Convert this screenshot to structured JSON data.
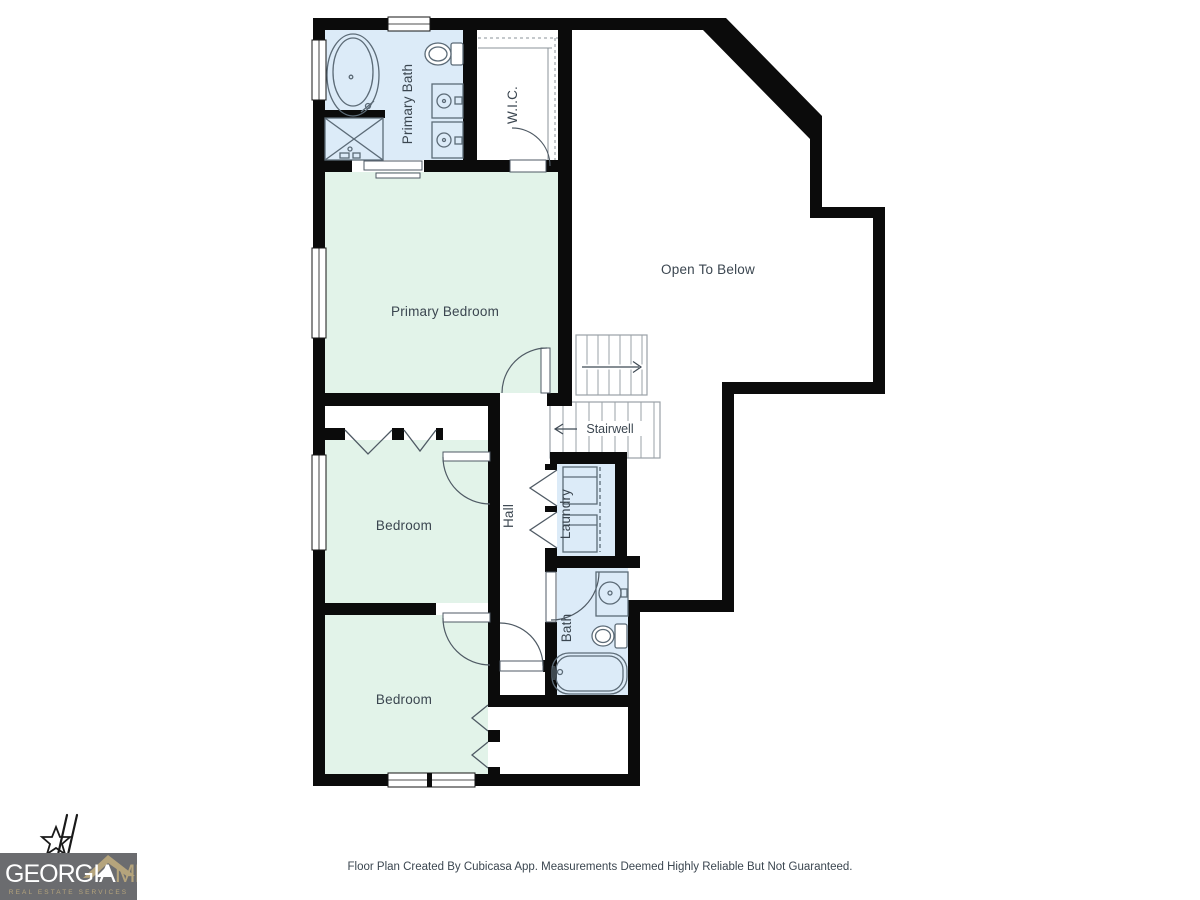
{
  "plan": {
    "rooms": {
      "primary_bath": {
        "label": "Primary Bath"
      },
      "wic": {
        "label": "W.I.C."
      },
      "open_to_below": {
        "label": "Open To Below"
      },
      "primary_bedroom": {
        "label": "Primary Bedroom"
      },
      "stairwell": {
        "label": "Stairwell"
      },
      "hall": {
        "label": "Hall"
      },
      "laundry": {
        "label": "Laundry"
      },
      "bedroom_upper": {
        "label": "Bedroom"
      },
      "bedroom_lower": {
        "label": "Bedroom"
      },
      "bath": {
        "label": "Bath"
      }
    }
  },
  "footer": {
    "disclaimer": "Floor Plan Created By Cubicasa App. Measurements Deemed Highly Reliable But Not Guaranteed."
  },
  "logo": {
    "brand_primary": "GEORGIA",
    "brand_secondary": "MLS",
    "tagline": "REAL ESTATE SERVICES"
  },
  "colors": {
    "wall": "#0b0b0b",
    "room_green": "#e2f3e9",
    "room_blue": "#dcebf8",
    "fixture_stroke": "#5c6b77",
    "label_text": "#3b4650",
    "logo_bg": "#6b6c6f",
    "logo_gold": "#b5a47c",
    "logo_text": "#ffffff"
  }
}
